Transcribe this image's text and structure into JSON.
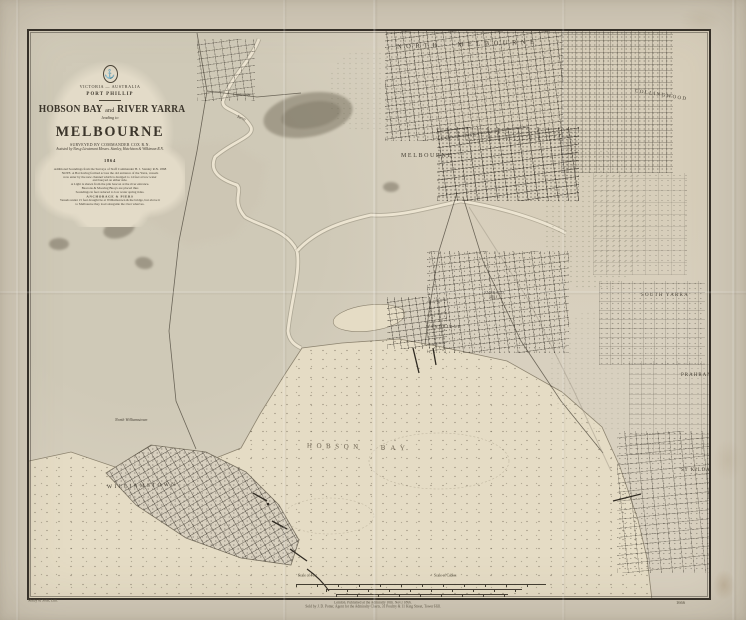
{
  "cartouche": {
    "region": "VICTORIA — AUSTRALIA",
    "port": "PORT PHILLIP",
    "title_left": "HOBSON BAY",
    "title_and": "and",
    "title_right": "RIVER YARRA",
    "leading_to": "leading to",
    "city": "MELBOURNE",
    "surveyed": "SURVEYED BY COMMANDER COX R.N.",
    "assisted": "Assisted by Nav.g Lieutenant Messrs. Stanley, Hutchison & Wilkinson R.N.",
    "year": "1864",
    "crest_icon": "admiralty-anchor-crest",
    "notes": [
      "Additional Soundings from the Surveys of Staff Commander H. J. Stanley R.N. 1868",
      "NOTE. A Bar having formed across the old entrance of the Yarra, vessels",
      "now enter by the new channel which is dredged to 14 feet at low water",
      "and buoyed on either side.",
      "A Light is shewn from the pile beacon at the river entrance.",
      "Beacons & Mooring Buoys are placed thus",
      "Soundings in feet reduced to low water spring tides.",
      "ANCHORAGE & PIERS",
      "Vessels under 15 feet draught lie at Williamstown & the bridge, but above it",
      "to Melbourne they load alongside the river wharves."
    ]
  },
  "places": {
    "north_melbourne": "NORTH MELBOURNE",
    "melbourne": "MELBOURNE",
    "collingwood": "COLLINGWOOD",
    "south_yarra": "SOUTH YARRA",
    "prahran": "PRAHRAN",
    "st_kilda": "ST KILDA",
    "williamstown": "WILLIAMSTOWN",
    "north_williamstown": "North Williamstown",
    "footscray": "Footscray",
    "yarra_river": "Yarra",
    "sandridge": "SANDRIDGE",
    "emerald_hill_line1": "EMERALD",
    "emerald_hill_line2": "HILL",
    "hobson": "HOBSON",
    "bay": "BAY"
  },
  "scale": {
    "label_left": "Scale of Feet",
    "label_right": "Scale of Cables"
  },
  "imprint": {
    "line1": "London. Published at the Admiralty 10th. Nov.r 1866.",
    "line2": "Sold by J. D. Potter, Agent for the Admiralty Charts, 31 Poultry & 11 King Street, Tower Hill."
  },
  "plate_number": "1666",
  "engraver": "Malby & Sons, Lith.",
  "colors": {
    "paper": "#d3cbba",
    "map_ground": "#d8d0bf",
    "water": "#e5dcc5",
    "ink": "#3b352b",
    "faded_ink": "#6f6553"
  }
}
